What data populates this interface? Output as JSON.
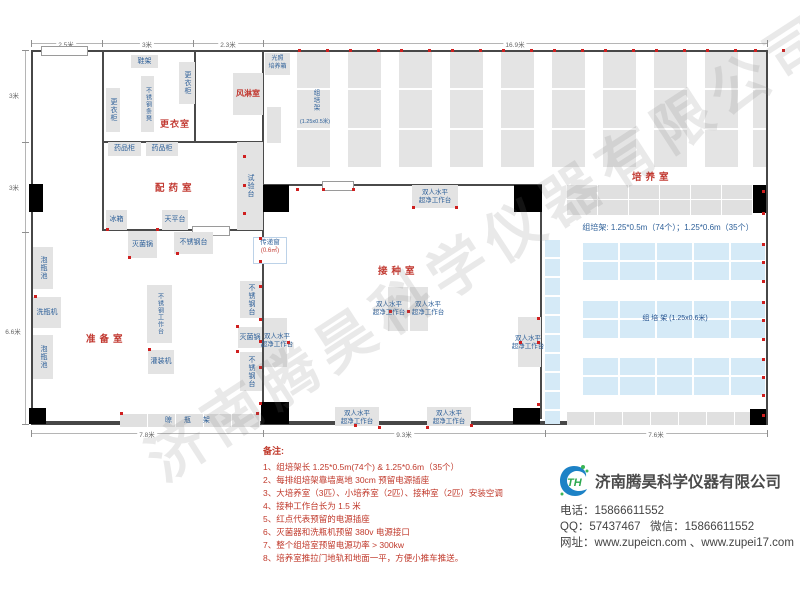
{
  "watermark": "济南腾昊科学仪器有限公司",
  "dims": {
    "top": [
      "2.5米",
      "3米",
      "2.3米",
      "16.9米"
    ],
    "left": [
      "3米",
      "3米",
      "6.6米"
    ],
    "bottom": [
      "7.8米",
      "9.3米",
      "7.6米"
    ]
  },
  "rooms": {
    "changing_room": "更衣室",
    "air_shower": "风淋室",
    "dispensing_room": "配药室",
    "prep_room": "准备室",
    "inoculation_room": "接种室",
    "culture_room": "培养室"
  },
  "labels": {
    "shoe_rack": "鞋架",
    "wardrobe": "更衣柜",
    "ss_bench": "不锈钢条凳",
    "medicine_cabinet": "药品柜",
    "test_bench": "试验台",
    "fridge": "冰箱",
    "balance": "天平台",
    "sterilizer": "灭菌锅",
    "ss_table": "不锈钢台",
    "soak_pool": "泡瓶池",
    "washer": "洗瓶机",
    "ss_workbench": "不锈钢工作台",
    "filler": "灌装机",
    "drying_rack": "晾 瓶 架",
    "transfer_window": "传递窗",
    "transfer_window_area": "(0.6㎡)",
    "clean_bench_l1": "双人水平",
    "clean_bench_l2": "超净工作台",
    "light_incubator_l1": "光照",
    "light_incubator_l2": "培养箱",
    "rack_v_name": "组培架",
    "rack_v_size": "(1.25x0.5米)",
    "rack_caption": "组培架: 1.25*0.5m（74个）；1.25*0.6m（35个）",
    "rack_h_label": "组  培  架 (1.25x0.6米)"
  },
  "notes": {
    "title": "备注:",
    "items": [
      "1、组培架长 1.25*0.5m(74个) & 1.25*0.6m（35个）",
      "2、每排组培架靠墙离地 30cm 预留电源插座",
      "3、大培养室（3匹）、小培养室（2匹）、接种室（2匹）安装空调",
      "4、接种工作台长为 1.5 米",
      "5、红点代表预留的电源插座",
      "6、灭菌器和洗瓶机预留 380v 电源接口",
      "7、整个组培室预留电源功率 > 300kw",
      "8、培养室推拉门地轨和地面一平，方便小推车推送。"
    ]
  },
  "contact": {
    "company": "济南腾昊科学仪器有限公司",
    "logo_text": "TH",
    "phone_label": "电话：",
    "phone": "15866611552",
    "qq_label": "QQ：",
    "qq": "57437467",
    "wechat_label": "微信：",
    "wechat": "15866611552",
    "web_label": "网址：",
    "web": "www.zupeicn.com 、www.zupei17.com"
  },
  "colors": {
    "accent_blue": "#2e6099",
    "label_red": "#c23a32",
    "rack_blue": "#d5eaf7",
    "equipment_gray": "#e3e3e3"
  }
}
